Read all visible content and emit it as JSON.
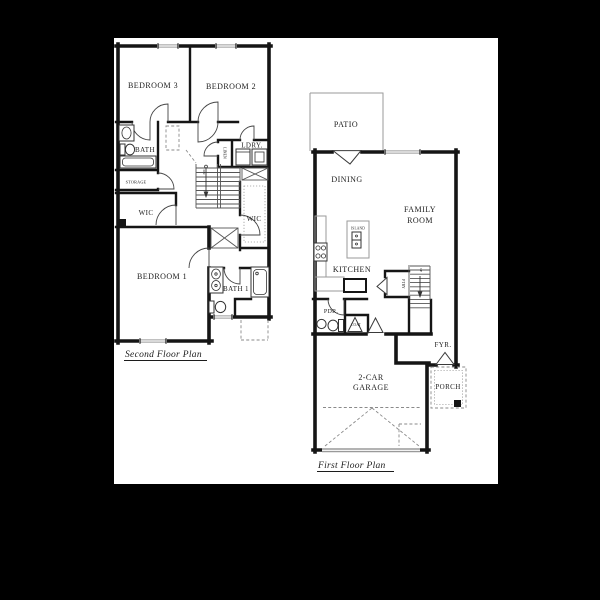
{
  "sheet": {
    "background_color": "#000000",
    "paper_color": "#ffffff",
    "wall_color": "#151515",
    "accent_gray": "#9a9a9a"
  },
  "second_floor": {
    "caption": "Second Floor Plan",
    "labels": {
      "bedroom3": "BEDROOM 3",
      "bedroom2": "BEDROOM 2",
      "bath": "BATH",
      "ldry": "LDRY.",
      "linen": "LINEN",
      "storage": "STORAGE",
      "wic_left": "WIC",
      "wic_right": "WIC",
      "bedroom1": "BEDROOM 1",
      "bath1": "BATH 1",
      "dn": "DN"
    }
  },
  "first_floor": {
    "caption": "First Floor Plan",
    "labels": {
      "patio": "PATIO",
      "dining": "DINING",
      "family_room_1": "FAMILY",
      "family_room_2": "ROOM",
      "island": "ISLAND",
      "kitchen": "KITCHEN",
      "ptry": "PTRY",
      "up": "UP",
      "pdr": "PDR.",
      "coat": "COAT",
      "fyr": "FYR.",
      "porch": "PORCH",
      "garage_1": "2-CAR",
      "garage_2": "GARAGE"
    }
  }
}
